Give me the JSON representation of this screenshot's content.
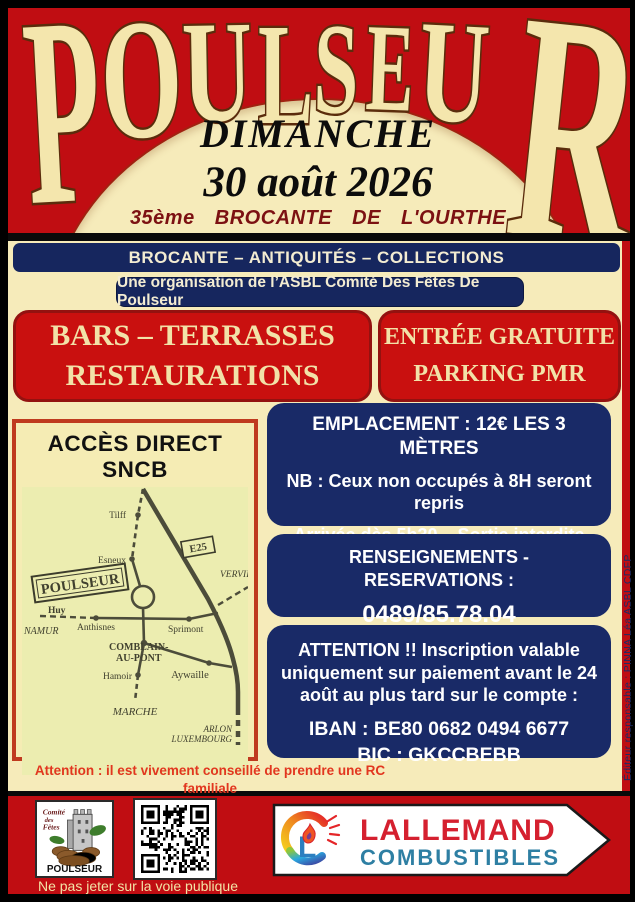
{
  "poster": {
    "title": "POULSEUR",
    "day": "DIMANCHE",
    "date": "30 août 2026",
    "edition_line": "35ème BROCANTE DE L'OURTHE"
  },
  "banners": {
    "banner1": "BROCANTE – ANTIQUITÉS – COLLECTIONS",
    "banner2": "Une organisation de l’ASBL Comité Des Fêtes De Poulseur"
  },
  "highlight_boxes": {
    "left_line1": "BARS – TERRASSES",
    "left_line2": "RESTAURATIONS",
    "right_line1": "ENTRÉE GRATUITE",
    "right_line2": "PARKING PMR"
  },
  "map": {
    "title": "ACCÈS DIRECT SNCB",
    "labels": {
      "tilff": "Tilff",
      "esneux": "Esneux",
      "poulseur": "POULSEUR",
      "e25": "E25",
      "verviers": "VERVIERS",
      "huy": "Huy",
      "namur": "NAMUR",
      "anthisnes": "Anthisnes",
      "sprimont": "Sprimont",
      "comblain1": "COMBLAIN-",
      "comblain2": "AU-PONT",
      "hamoir": "Hamoir",
      "aywaille": "Aywaille",
      "marche": "MARCHE",
      "arlon": "ARLON",
      "luxembourg": "LUXEMBOURG"
    }
  },
  "info": {
    "emplacement": {
      "line1": "EMPLACEMENT : 12€ LES 3 MÈTRES",
      "line2": "NB : Ceux non occupés à 8H seront repris",
      "line3": "Arrivée dès 5h30 – Sortie interdite avant 18h"
    },
    "renseignements": {
      "title": "RENSEIGNEMENTS - RESERVATIONS :",
      "phone1": "0489/85.78.04",
      "phone2": "04/380.04.26"
    },
    "attention": {
      "text": "ATTENTION !! Inscription valable uniquement sur paiement avant le 24 août au plus tard sur le compte :",
      "iban": "IBAN : BE80 0682 0494 6677",
      "bic": "BIC : GKCCBEBB"
    }
  },
  "warning": {
    "line1": "Attention : il est vivement conseillé de prendre une RC familiale",
    "line2": "Le comité décline toute responsabilité en cas d’accident ou d’incident."
  },
  "editor_note": "Éditeur responsable : PINNA Léa ASBL CDFP",
  "footer": {
    "comite_logo": {
      "line1": "Comité",
      "line2": "des",
      "line3": "Fêtes",
      "name": "POULSEUR"
    },
    "qr_code": "qr-code",
    "lallemand": {
      "line1": "LALLEMAND",
      "line2": "COMBUSTIBLES"
    },
    "ne_pas_jeter": "Ne pas jeter sur la voie publique"
  },
  "colors": {
    "poster_red": "#c00d12",
    "cream": "#f6ebba",
    "navy": "#16265e",
    "box_red": "#c9100f",
    "maroon_text": "#7c1112",
    "warning_red": "#e2361f",
    "lallemand_red": "#d5202f",
    "lallemand_teal": "#2e7fa3"
  }
}
